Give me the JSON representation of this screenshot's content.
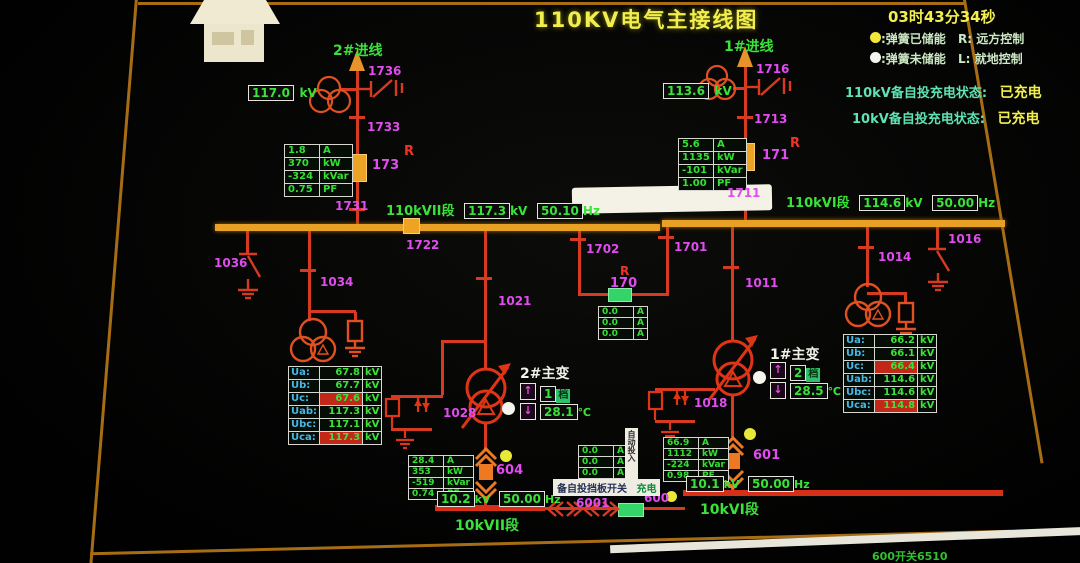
{
  "colors": {
    "closed_breaker": "#eda323",
    "open_breaker": "#35d468",
    "line": "#d63a20",
    "bus_110kv": "#e8a125",
    "bus_10kv": "#d63018",
    "device_label": "#e14cf0",
    "value_text": "#3ae23a",
    "title_text": "#f2ee4e",
    "alarm_bg": "#c22718"
  },
  "header": {
    "title": "110KV电气主接线图",
    "clock": "03时43分34秒",
    "legend": [
      {
        "dot": "#f2e838",
        "text": ":弹簧已储能",
        "mode": "R: 远方控制"
      },
      {
        "dot": "#f5f5ee",
        "text": ":弹簧未储能",
        "mode": "L: 就地控制"
      }
    ],
    "status": [
      {
        "label": "110kV备自投充电状态:",
        "value": "已充电"
      },
      {
        "label": "10kV备自投充电状态:",
        "value": "已充电"
      }
    ]
  },
  "feeder_left": {
    "name": "2#进线",
    "kv": "117.0",
    "kv_unit": "kV",
    "s_line": "1736",
    "s_upper": "1733",
    "brk": "173",
    "r": "R",
    "s_lower": "1731",
    "meter": {
      "rows": [
        [
          "1.8",
          "A"
        ],
        [
          "370",
          "kW"
        ],
        [
          "-324",
          "kVar"
        ],
        [
          "0.75",
          "PF"
        ]
      ]
    }
  },
  "feeder_right": {
    "name": "1#进线",
    "kv": "113.6",
    "kv_unit": "kV",
    "s_line": "1716",
    "s_upper": "1713",
    "brk": "171",
    "r": "R",
    "s_lower": "1711",
    "meter": {
      "rows": [
        [
          "5.6",
          "A"
        ],
        [
          "1135",
          "kW"
        ],
        [
          "-101",
          "kVar"
        ],
        [
          "1.00",
          "PF"
        ]
      ]
    }
  },
  "bus_ii": {
    "name": "110kVII段",
    "kv": "117.3",
    "kv_unit": "kV",
    "hz": "50.10",
    "hz_unit": "Hz",
    "es": "1036",
    "pt": "1034",
    "sec": "1722",
    "v": {
      "rows": [
        {
          "label": "Ua:",
          "value": "67.8",
          "unit": "kV"
        },
        {
          "label": "Ub:",
          "value": "67.7",
          "unit": "kV"
        },
        {
          "label": "Uc:",
          "value": "67.6",
          "unit": "kV"
        },
        {
          "label": "Uab:",
          "value": "117.3",
          "unit": "kV"
        },
        {
          "label": "Ubc:",
          "value": "117.1",
          "unit": "kV"
        },
        {
          "label": "Uca:",
          "value": "117.3",
          "unit": "kV"
        }
      ]
    }
  },
  "bus_i": {
    "name": "110kVI段",
    "kv": "114.6",
    "kv_unit": "kV",
    "hz": "50.00",
    "hz_unit": "Hz",
    "pt": "1014",
    "es": "1016",
    "v": {
      "rows": [
        {
          "label": "Ua:",
          "value": "66.2",
          "unit": "kV"
        },
        {
          "label": "Ub:",
          "value": "66.1",
          "unit": "kV"
        },
        {
          "label": "Uc:",
          "value": "66.4",
          "unit": "kV"
        },
        {
          "label": "Uab:",
          "value": "114.6",
          "unit": "kV"
        },
        {
          "label": "Ubc:",
          "value": "114.6",
          "unit": "kV"
        },
        {
          "label": "Uca:",
          "value": "114.8",
          "unit": "kV"
        }
      ]
    }
  },
  "bus_tie": {
    "dl": "1702",
    "dr": "1701",
    "brk": "170",
    "r": "R",
    "meter": {
      "rows": [
        [
          "0.0",
          "A"
        ],
        [
          "0.0",
          "A"
        ],
        [
          "0.0",
          "A"
        ]
      ]
    }
  },
  "tx2": {
    "name": "2#主变",
    "disc": "1021",
    "arr": "1028",
    "raise": "↑",
    "lower": "↓",
    "tap": "1",
    "tap_u": "档",
    "temp": "28.1",
    "temp_u": "℃",
    "brk": "604",
    "meter": {
      "rows": [
        [
          "28.4",
          "A"
        ],
        [
          "353",
          "kW"
        ],
        [
          "-519",
          "kVar"
        ],
        [
          "0.74",
          "PF"
        ]
      ]
    }
  },
  "tx1": {
    "name": "1#主变",
    "disc": "1011",
    "arr": "1018",
    "raise": "↑",
    "lower": "↓",
    "tap": "2",
    "tap_u": "档",
    "temp": "28.5",
    "temp_u": "℃",
    "brk": "601",
    "meter": {
      "rows": [
        [
          "66.9",
          "A"
        ],
        [
          "1112",
          "kW"
        ],
        [
          "-224",
          "kVar"
        ],
        [
          "0.98",
          "PF"
        ]
      ]
    }
  },
  "lv": {
    "bus_ii": {
      "name": "10kVII段",
      "kv": "10.2",
      "kv_unit": "kV",
      "hz": "50.00",
      "hz_unit": "Hz"
    },
    "bus_i": {
      "name": "10kVI段",
      "kv": "10.1",
      "kv_unit": "kV",
      "hz": "50.00",
      "hz_unit": "Hz"
    },
    "tie": {
      "disc": "6001",
      "brk": "600",
      "meter": {
        "rows": [
          [
            "0.0",
            "A"
          ],
          [
            "0.0",
            "A"
          ],
          [
            "0.0",
            "A"
          ]
        ]
      },
      "tag": "自动投入",
      "banner": "备自投挡板开关",
      "banner_state": "充电"
    }
  },
  "footer": {
    "text": "600开关6510"
  }
}
